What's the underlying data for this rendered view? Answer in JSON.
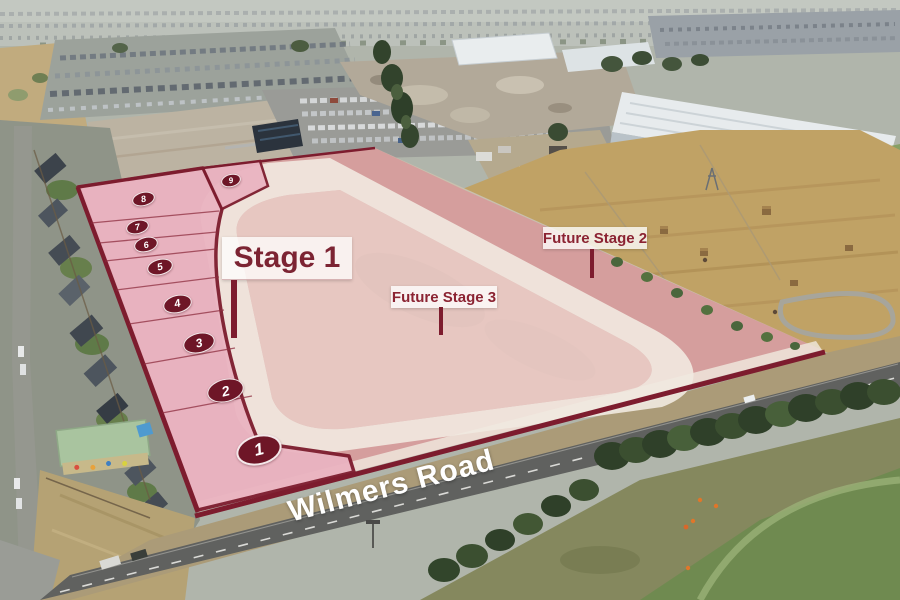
{
  "title": "Aerial subdivision staging plan",
  "road": {
    "name": "Wilmers Road"
  },
  "stages": {
    "stage1": {
      "label": "Stage 1"
    },
    "future2": {
      "label": "Future Stage 2"
    },
    "future3": {
      "label": "Future Stage 3"
    }
  },
  "lots": [
    "1",
    "2",
    "3",
    "4",
    "5",
    "6",
    "7",
    "8",
    "9"
  ],
  "colors": {
    "stage1_fill": "#eab4c1",
    "future_overlay_pink": "#e27a8a",
    "outline_maroon": "#7d1c2e",
    "lot_badge_fill": "#6e1627",
    "loop_road_cream": "#f2ece2",
    "label_text": "#8b2332",
    "road_text": "#ffffff"
  }
}
